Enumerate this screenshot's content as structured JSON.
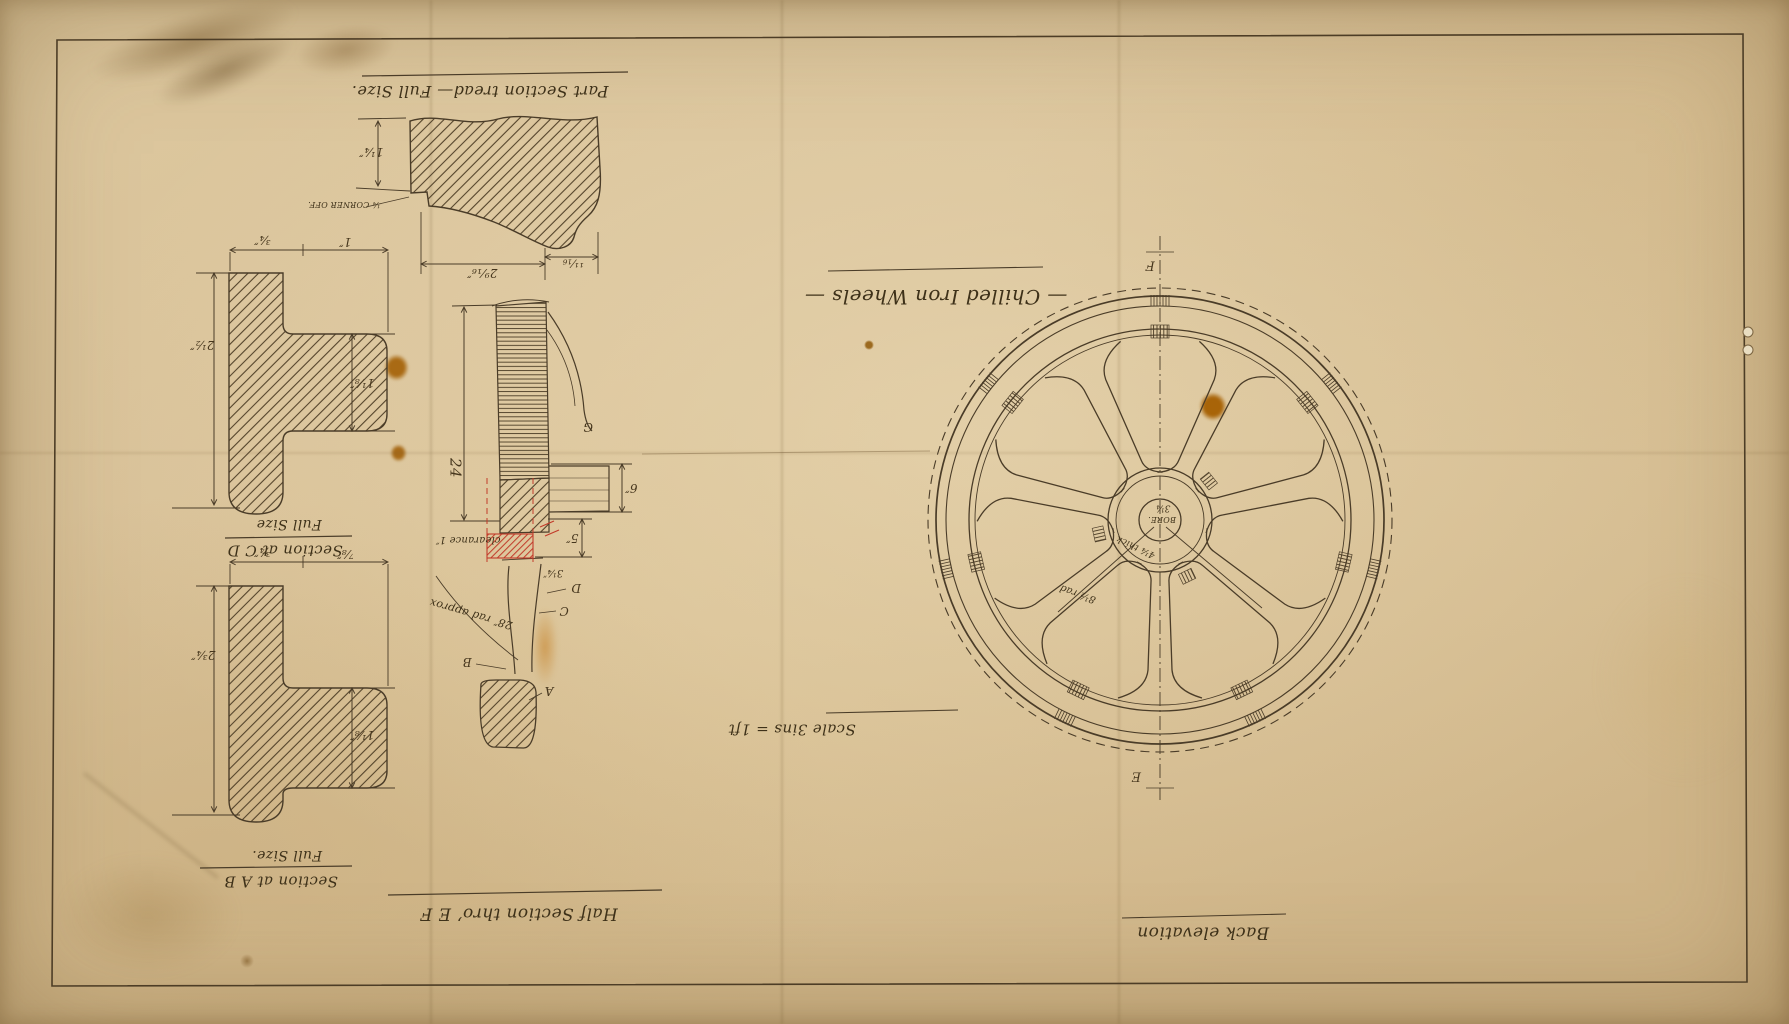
{
  "title": "— Chilled Iron Wheels —",
  "notes": {
    "scale": "Scale 3ins = 1ft"
  },
  "views": {
    "tread": {
      "caption": "Part Section tread— Full Size.",
      "dim_height": "1¼″",
      "note_corner": "¼ CORNER OFF.",
      "dim_width_left": "2⁹⁄₁₆″",
      "dim_width_right": "¹¹⁄₁₆"
    },
    "section_cd": {
      "caption": "Section at C D",
      "caption_sub": "Full Size",
      "dim_top_left": "¾″",
      "dim_top_right": "1″",
      "dim_left": "2½″",
      "dim_inner": "1⅛″"
    },
    "section_ab": {
      "caption": "Section at A B",
      "caption_sub": "Full Size.",
      "dim_top_left": "¾″",
      "dim_top_right": "⅞″",
      "dim_left": "2¾″",
      "dim_inner": "1⅛″"
    },
    "half_section": {
      "caption": "Half Section thro’ E F",
      "dim_depth": "24",
      "dim_six": "6″",
      "dim_five": "5″",
      "dim_bore": "3¼″",
      "note_clearance": "clearance 1″",
      "note_radius": "28″ rad approx",
      "letter_a": "A",
      "letter_b": "B",
      "letter_c": "C",
      "letter_d": "D",
      "letter_g": "G"
    },
    "back_elevation": {
      "caption": "Back elevation",
      "marker_top": "F",
      "marker_bottom": "E",
      "hub_bore_value": "3¼",
      "hub_bore_word": "BORE.",
      "note_thick": "4¼ thick",
      "note_rad": "8½ rad"
    }
  },
  "colors": {
    "ink": "#4a3c28",
    "red": "#c23b2a",
    "paper": "#d8c199"
  }
}
